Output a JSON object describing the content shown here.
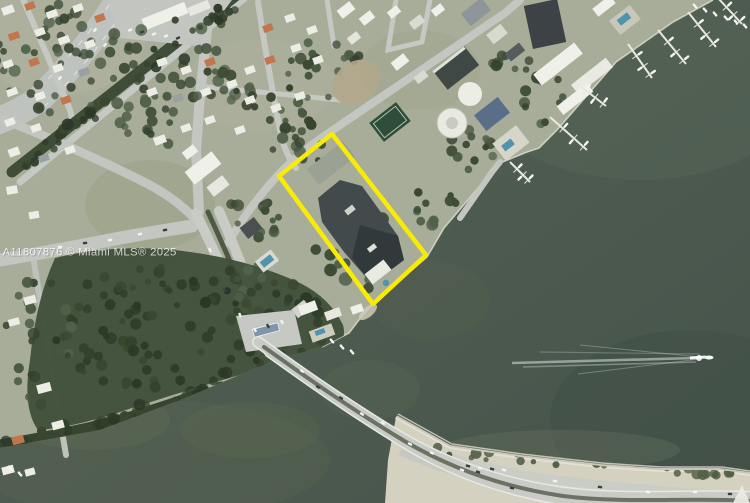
{
  "image": {
    "alt": "Satellite aerial photo of a bayfront property with highlighted parcel boundary, causeway bridge, marina and bay",
    "watermark": "A11807876 © Miami MLS® 2025"
  },
  "overlay": {
    "property_outline_color": "#f8eb05",
    "marker": "triangle-marker"
  },
  "colors": {
    "water": "#4e5c50",
    "water_deep": "#44524a",
    "water_shallow": "#68745a",
    "land": "#a8ad99",
    "forest": "#41503a",
    "sand": "#d4d1c0",
    "road": "#c4c7c1",
    "building_white": "#f0f0ea",
    "building_dark": "#3c4245",
    "pool": "#4f93ad",
    "median_green": "#3f4c38",
    "property_outline": "#f8eb05",
    "watermark_text": "#ffffff"
  }
}
